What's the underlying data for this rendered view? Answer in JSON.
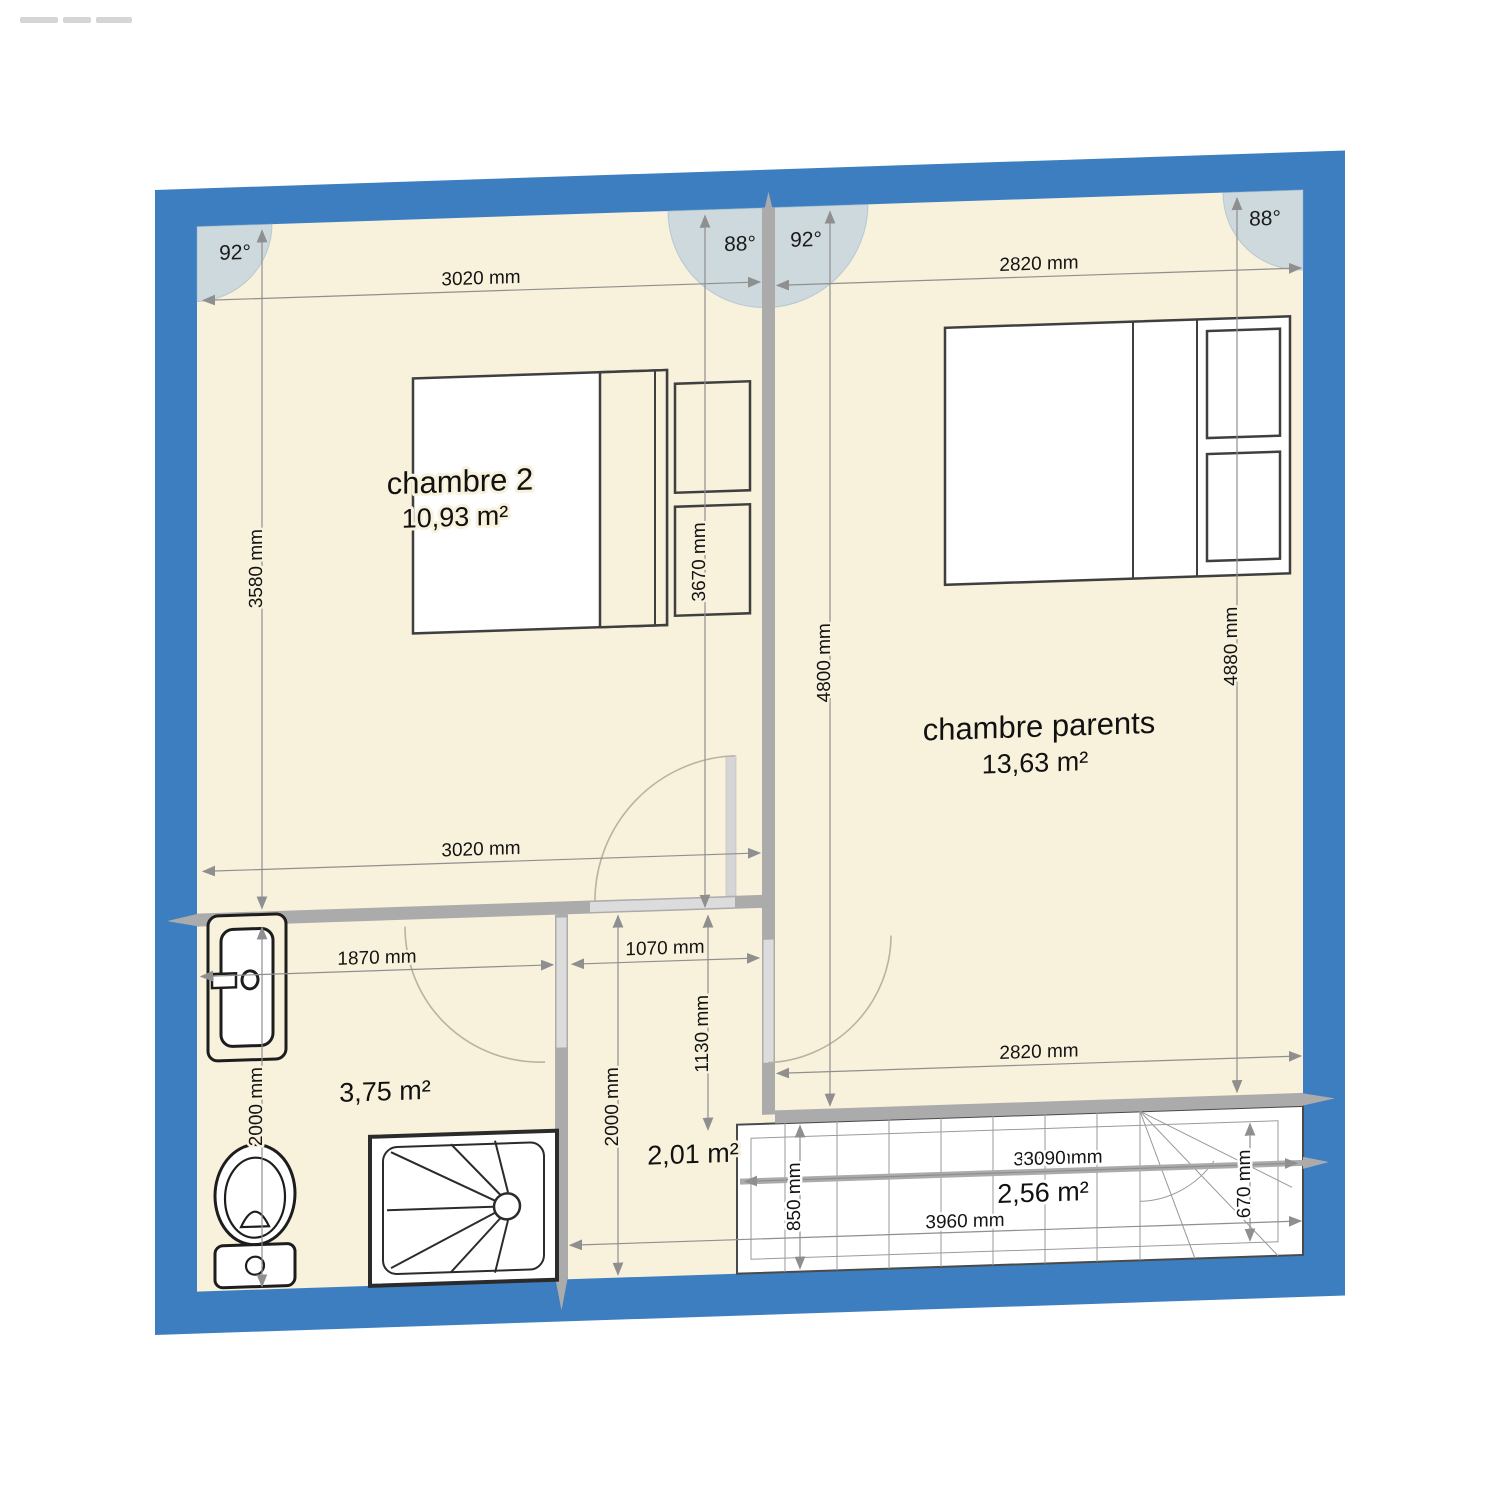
{
  "plan": {
    "angles": {
      "top_left": "92°",
      "top_mid_left": "88°",
      "top_mid_right": "92°",
      "top_right": "88°"
    },
    "rooms": {
      "chambre2": {
        "name": "chambre 2",
        "area": "10,93 m²"
      },
      "parents": {
        "name": "chambre parents",
        "area": "13,63 m²"
      },
      "bathroom": {
        "area": "3,75 m²"
      },
      "hall": {
        "area": "2,01 m²"
      },
      "stairs": {
        "area": "2,56 m²"
      }
    },
    "dimensions": {
      "ch2_top": "3020 mm",
      "ch2_bottom": "3020 mm",
      "ch2_left": "3580 mm",
      "ch2_bed": "3670 mm",
      "parents_top": "2820 mm",
      "parents_bottom": "2820 mm",
      "parents_left": "4800 mm",
      "parents_right": "4880 mm",
      "bath_width": "1870 mm",
      "bath_height": "2000 mm",
      "hall_width": "1070 mm",
      "hall_side": "1130 mm",
      "hall_height": "2000 mm",
      "stairs_dim_a": "3030 mm",
      "stairs_dim_b": "3090 mm",
      "stairs_width": "3960 mm",
      "stairs_left": "850 mm",
      "stairs_right": "670 mm"
    },
    "colors": {
      "exterior_wall": "#3c7ec0",
      "floor": "#f8f1dc",
      "interior_wall": "#ababab",
      "door_opening": "#dcdcdc",
      "angle_arc_fill": "#aac4dd",
      "dimension_line": "#8f8f8f"
    }
  }
}
